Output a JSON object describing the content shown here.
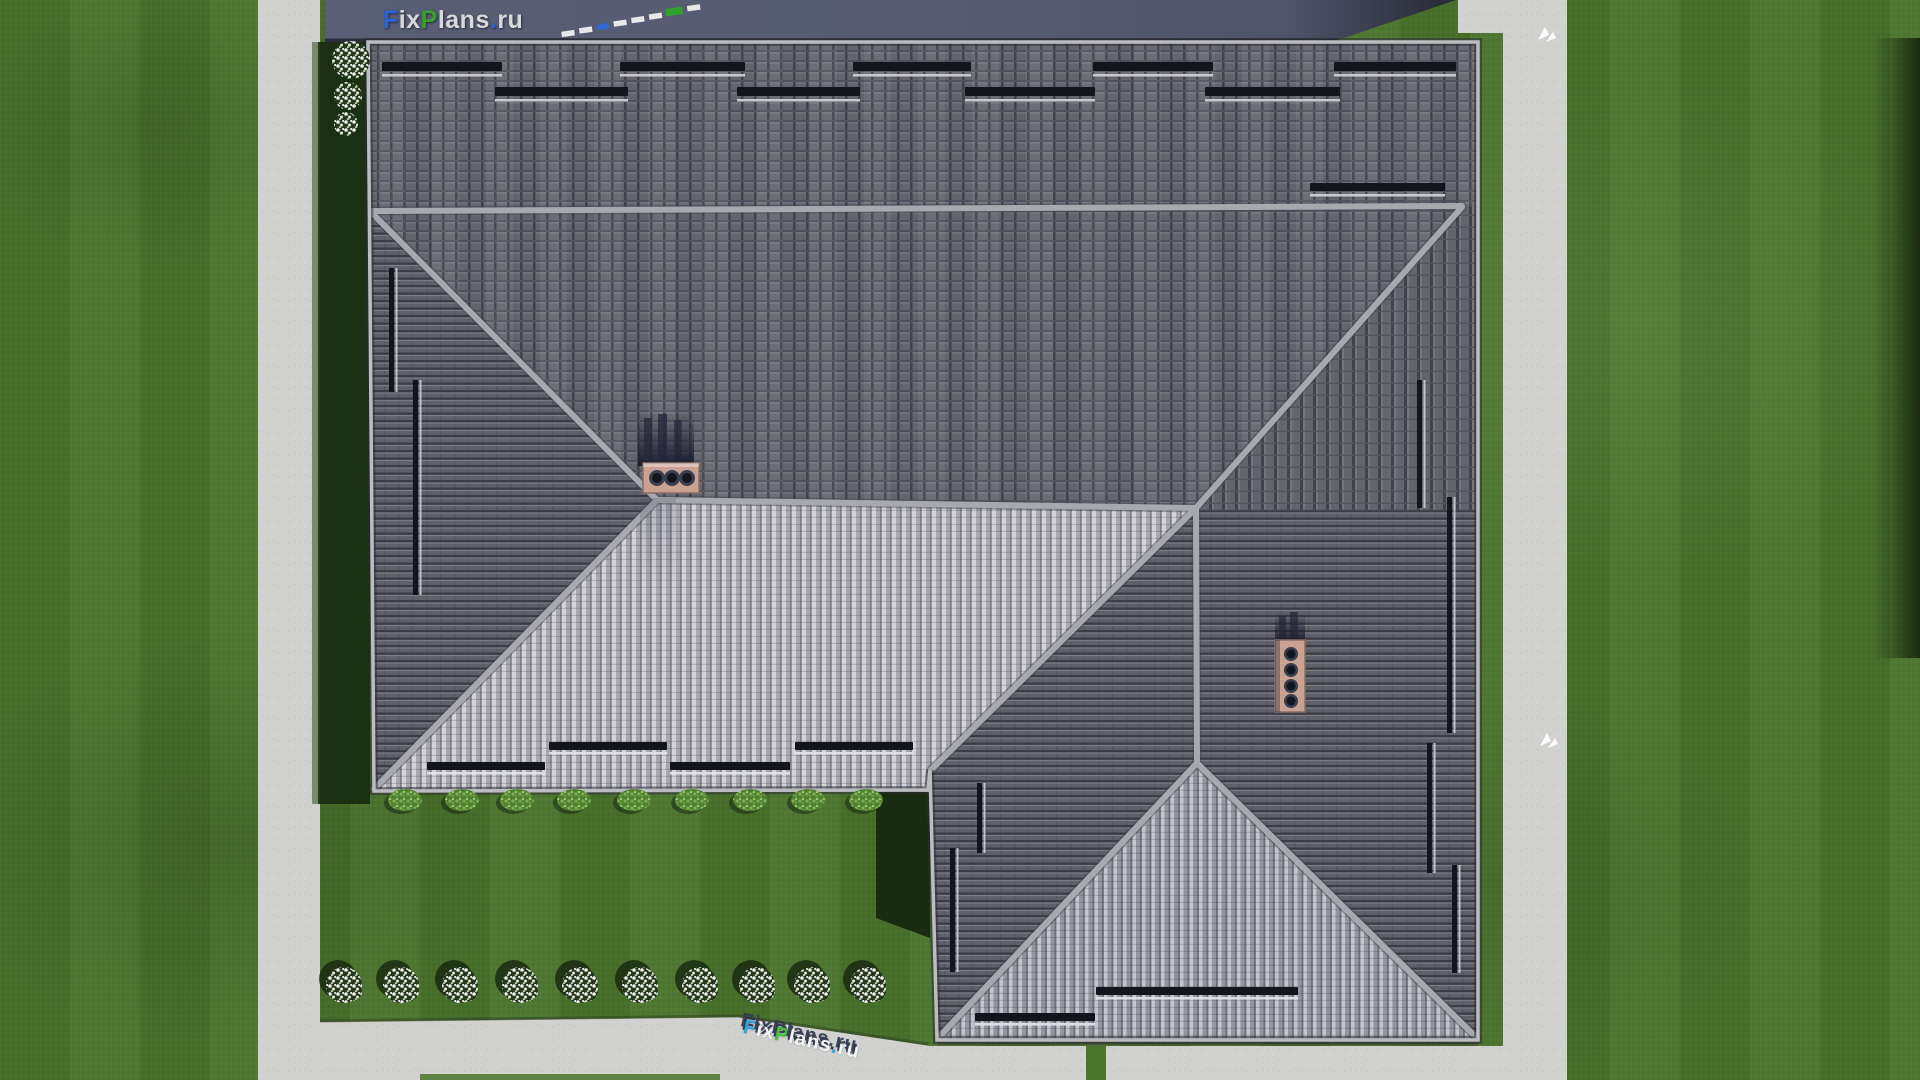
{
  "watermarks": {
    "top": {
      "text": "FixPlans.ru",
      "parts": [
        {
          "t": "F",
          "color": "#2b62d9"
        },
        {
          "t": "ix",
          "color": "#d9d9db"
        },
        {
          "t": "P",
          "color": "#35a02a"
        },
        {
          "t": "lans",
          "color": "#d9d9db"
        },
        {
          "t": ".",
          "color": "#2b62d9"
        },
        {
          "t": "ru",
          "color": "#d9d9db"
        }
      ]
    },
    "bottom": {
      "text": "FixPlans.ru",
      "parts": [
        {
          "t": "F",
          "color": "#2aa7e0"
        },
        {
          "t": "ix",
          "color": "#f4f4f4"
        },
        {
          "t": "P",
          "color": "#46c03a"
        },
        {
          "t": "lans",
          "color": "#f4f4f4"
        },
        {
          "t": ".",
          "color": "#2aa7e0"
        },
        {
          "t": "ru",
          "color": "#f4f4f4"
        }
      ]
    }
  },
  "scene": {
    "view": "top-down 3D render of a house hip roof with gray tiles",
    "chimney_left_pots": 3,
    "chimney_right_pots": 4,
    "flower_bushes_bottom_row": 10,
    "flower_bushes_top_left": 3,
    "hedge_tufts_below_eave": 9,
    "snow_guard_rows_top_slope": 2,
    "white_path_arrows": 2
  },
  "theme": {
    "grass": "#4b752c",
    "grass-dark": "#182a10",
    "path": "#d1d1cf",
    "band": "#565b71",
    "roof-grid": "#676770",
    "roof-rows": "#60606a",
    "roof-cols": "#64646c",
    "roof-light": "#a7a7af",
    "roof-mid": "#94969f",
    "ridge": "#a8a9af",
    "brick": "#c9a294",
    "guard": "#14141c",
    "rail": "#d4d5d9"
  }
}
